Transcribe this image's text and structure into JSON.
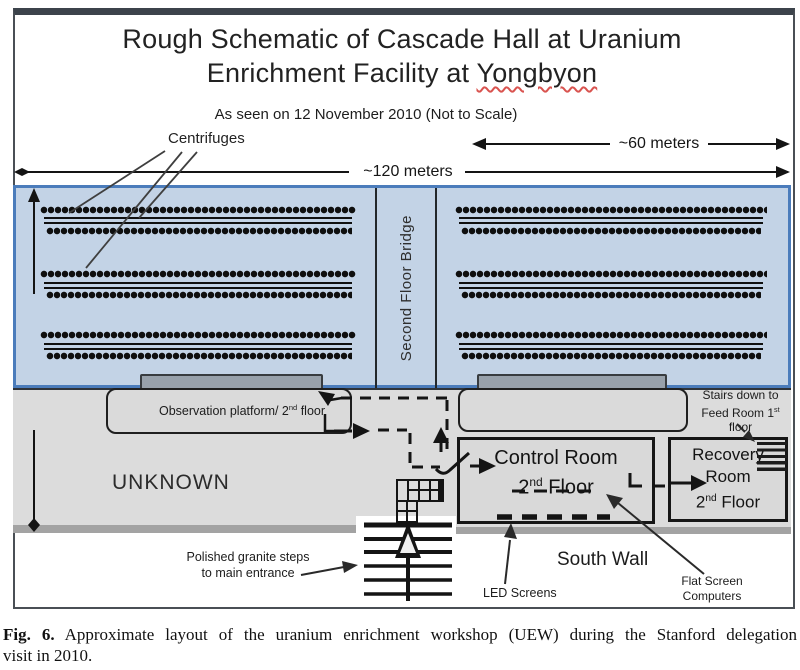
{
  "figure": {
    "title_line1": "Rough Schematic of Cascade Hall at Uranium",
    "title_line2_prefix": "Enrichment Facility at ",
    "title_line2_underlined": "Yongbyon",
    "subtitle": "As seen on 12 November 2010 (Not to Scale)",
    "dim_width_total": "~120 meters",
    "dim_width_right": "~60 meters",
    "dim_height": "~18 meters",
    "centrifuges_label": "Centrifuges",
    "bridge_label": "Second Floor Bridge",
    "observation_label": {
      "pre": "Observation platform/ 2",
      "sup": "nd",
      "post": " floor"
    },
    "unknown_label": "UNKNOWN",
    "control_room": {
      "line1": "Control Room",
      "floor_num": "2",
      "floor_sup": "nd",
      "floor_word": " Floor"
    },
    "recovery_room": {
      "line1": "Recovery",
      "line2": "Room",
      "floor_num": "2",
      "floor_sup": "nd",
      "floor_word": " Floor"
    },
    "stairs_down": {
      "line1": "Stairs down to",
      "line2_pre": "Feed Room 1",
      "line2_sup": "st",
      "line3": "floor"
    },
    "granite_steps": {
      "line1": "Polished granite steps",
      "line2": "to main entrance"
    },
    "led_label": "LED Screens",
    "south_wall_label": "South Wall",
    "flat_screen": {
      "line1": "Flat Screen",
      "line2": "Computers"
    }
  },
  "caption": {
    "fig_label": "Fig. 6.",
    "line1": "Approximate layout of the uranium enrichment workshop (UEW) during the Stanford delegation",
    "line2": "visit in 2010."
  },
  "colors": {
    "hall_fill": "#c3d3e6",
    "hall_border": "#4b7cbb",
    "room_fill": "#dcdcdc",
    "band": "#a3a3a3",
    "ink": "#141414",
    "underline_red": "#d9534f"
  },
  "diagram": {
    "sections": 2,
    "centrifuge_groups_per_section": 3,
    "dot_rows_per_group": 2
  }
}
